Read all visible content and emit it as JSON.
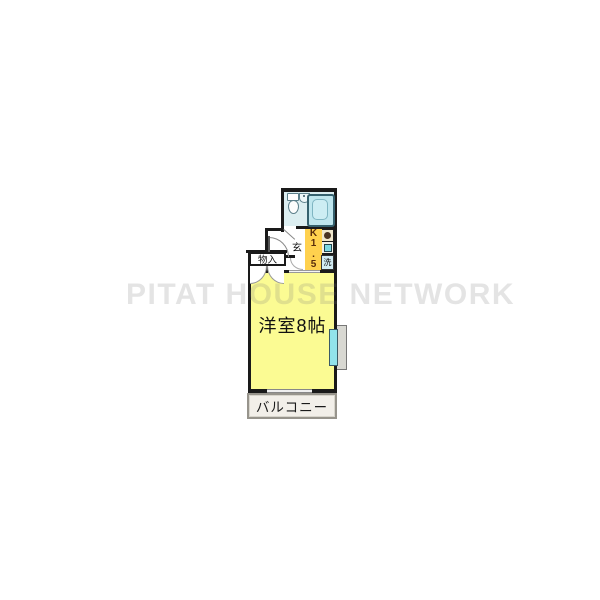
{
  "watermark": {
    "text": "PITAT HOUSE NETWORK"
  },
  "plan": {
    "main_room": {
      "label": "洋室8帖"
    },
    "balcony": {
      "label": "バルコニー"
    },
    "closet": {
      "label": "物入"
    },
    "entrance": {
      "label": "玄"
    },
    "kitchen": {
      "label": "K1.5",
      "chars": [
        "K",
        "1",
        ".",
        "5"
      ]
    },
    "laundry": {
      "label": "洗"
    },
    "fixtures": [
      "toilet",
      "washbasin",
      "bathtub",
      "stove-burner",
      "kitchen-sink",
      "bay-window",
      "sliding-window",
      "entrance-door",
      "closet-double-doors",
      "bathroom-door"
    ]
  },
  "colors": {
    "wall": "#1a1a1a",
    "room-yellow": "#fbfb93",
    "kitchen-gold": "#ffd14e",
    "bath-floor": "#dceef1",
    "tub-fill": "#bfe6ee",
    "window-cyan": "#91e3eb",
    "balcony-bg": "#f2efe9",
    "watermark-gray": "rgba(120,120,120,0.20)"
  }
}
